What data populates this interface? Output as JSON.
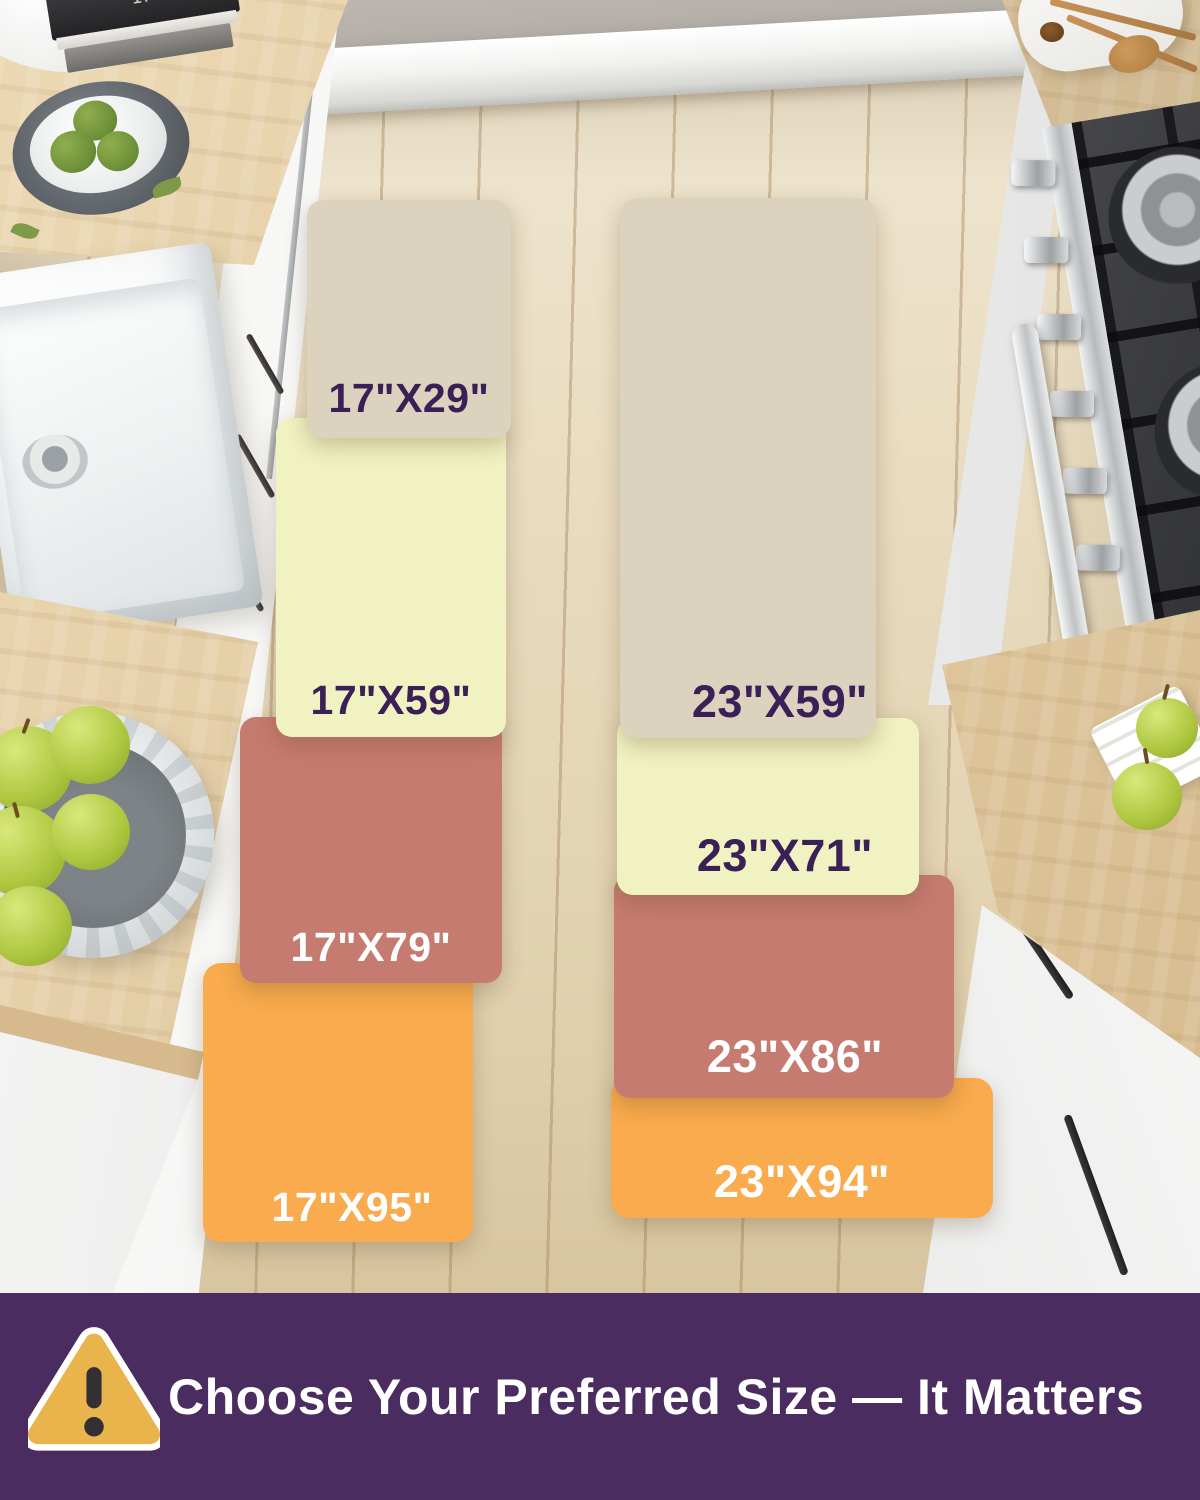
{
  "columns": [
    {
      "name": "17-inch wide runner sizes",
      "mats": [
        {
          "label": "17\"X29\"",
          "color_key": "beige",
          "text": "dark"
        },
        {
          "label": "17\"X59\"",
          "color_key": "yellow",
          "text": "dark"
        },
        {
          "label": "17\"X79\"",
          "color_key": "salmon",
          "text": "light"
        },
        {
          "label": "17\"X95\"",
          "color_key": "orange",
          "text": "light"
        }
      ]
    },
    {
      "name": "23-inch wide runner sizes",
      "mats": [
        {
          "label": "23\"X59\"",
          "color_key": "beige",
          "text": "dark"
        },
        {
          "label": "23\"X71\"",
          "color_key": "yellow",
          "text": "dark"
        },
        {
          "label": "23\"X86\"",
          "color_key": "salmon",
          "text": "light"
        },
        {
          "label": "23\"X94\"",
          "color_key": "orange",
          "text": "light"
        }
      ]
    }
  ],
  "colors": {
    "beige": "#dcd3bf",
    "yellow": "#f0f2c1",
    "salmon": "#c67b70",
    "orange": "#f9ab4d",
    "banner_bg": "#4b2c61",
    "label_dark": "#3a2057",
    "label_light": "#ffffff",
    "warning_fill": "#e9b44c",
    "warning_outline": "#ffffff",
    "warning_mark": "#332f33"
  },
  "banner": {
    "text": "Choose Your Preferred Size — It Matters",
    "icon": "warning-triangle-icon"
  },
  "decor": {
    "book_spine_text": "MAKING IT"
  }
}
